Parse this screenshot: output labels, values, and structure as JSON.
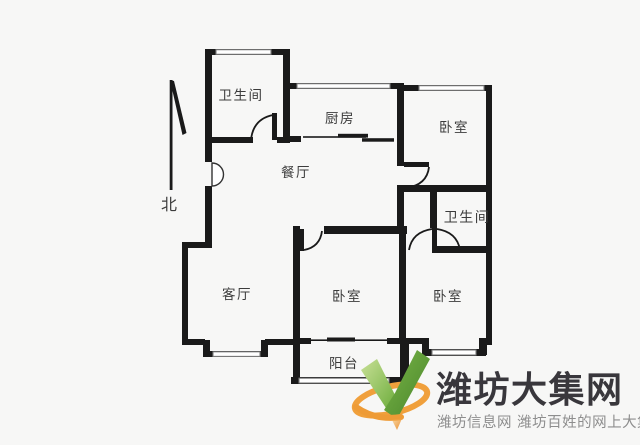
{
  "compass": {
    "label": "北"
  },
  "rooms": [
    {
      "name": "bathroom-top",
      "label": "卫生间"
    },
    {
      "name": "kitchen",
      "label": "厨房"
    },
    {
      "name": "bedroom-north",
      "label": "卧室"
    },
    {
      "name": "dining-room",
      "label": "餐厅"
    },
    {
      "name": "bathroom-east",
      "label": "卫生间"
    },
    {
      "name": "living-room",
      "label": "客厅"
    },
    {
      "name": "bedroom-south-mid",
      "label": "卧室"
    },
    {
      "name": "bedroom-south-east",
      "label": "卧室"
    },
    {
      "name": "balcony",
      "label": "阳台"
    }
  ],
  "watermark": {
    "site_name": "潍坊大集网",
    "tagline": "潍坊信息网 潍坊百姓的网上大集"
  },
  "colors": {
    "wall": "#1a1a1a",
    "window_line": "#7d7d7d",
    "label_text": "#3c3c3c",
    "title_text": "#39373c",
    "tagline_text": "#8e8e8e",
    "logo_green_light": "#9cc95c",
    "logo_green_dark": "#55962e",
    "logo_orange": "#ef9d3a",
    "background": "#f7f7f6"
  }
}
